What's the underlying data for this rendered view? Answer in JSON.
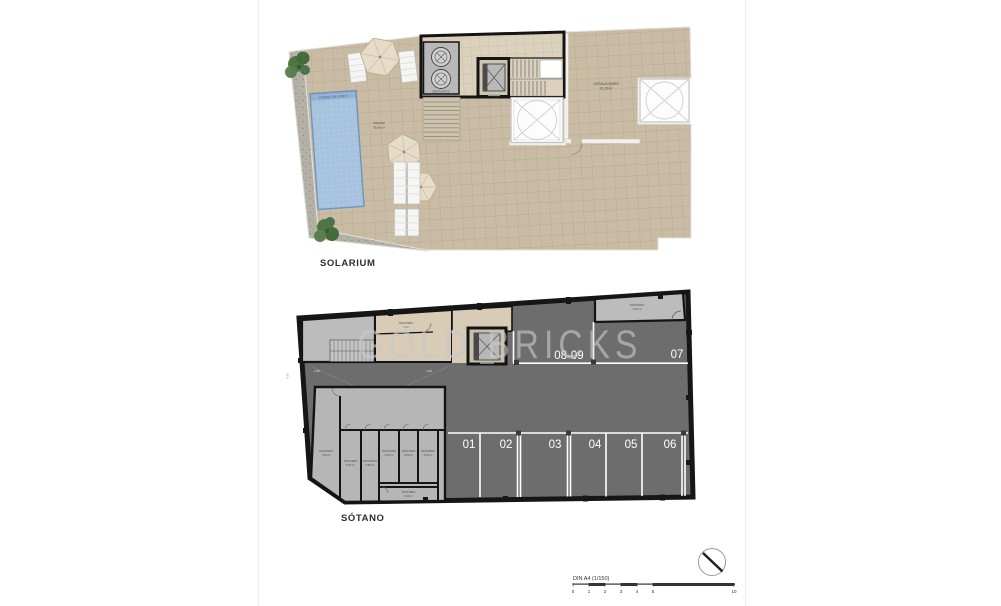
{
  "watermark": {
    "text": "GOLD BRICKS"
  },
  "colors": {
    "terrace": "#c9bba4",
    "pool": "#a6c2de",
    "walkway": "#b4b2a7",
    "parking_floor": "#6d6d6d",
    "storage_gray": "#b6b6b6",
    "corridor_beige": "#d8ccb6",
    "wall_black": "#161616",
    "stall_line": "#ffffff",
    "watermark_gray": "#c9c9c9"
  },
  "solarium": {
    "title": "SOLARIUM",
    "pool_dim_label": "PISCINA 7,50 x 2,50 m",
    "pool_name": "PISCINA",
    "pool_area": "35,80 m²",
    "installations_name": "INSTALACIONES",
    "installations_area": "41,78 m²",
    "deposits_label": "DEPÓSITOS"
  },
  "sotano": {
    "title": "SÓTANO",
    "stalls": [
      "01",
      "02",
      "03",
      "04",
      "05",
      "06"
    ],
    "top_stalls": [
      "08-09",
      "07"
    ],
    "ramp_label": "15%",
    "dim_left": "4,90",
    "dim_a": "2,55",
    "dim_b": "2,45",
    "trasteros": {
      "hall": {
        "name": "TRASTERO",
        "area": "7 m²"
      },
      "top_right": {
        "name": "TRASTERO",
        "area": "7,50 m²"
      },
      "left": {
        "name": "TRASTERO",
        "area": "7,30 m²"
      },
      "r1": {
        "name": "TRASTERO",
        "area": "5,60 m²"
      },
      "r2": {
        "name": "TRASTERO",
        "area": "5,50 m²"
      },
      "r3": {
        "name": "TRASTERO",
        "area": "5,00 m²"
      },
      "r4": {
        "name": "TRASTERO",
        "area": "5,00 m²"
      },
      "r5": {
        "name": "TRASTERO",
        "area": "5,00 m²"
      },
      "bottom": {
        "name": "TRASTERO",
        "area": "6,00 m²"
      }
    }
  },
  "scale": {
    "title": "DIN A4 (1/150)",
    "ticks": [
      "0",
      "1",
      "2",
      "3",
      "4",
      "5",
      "10"
    ]
  }
}
